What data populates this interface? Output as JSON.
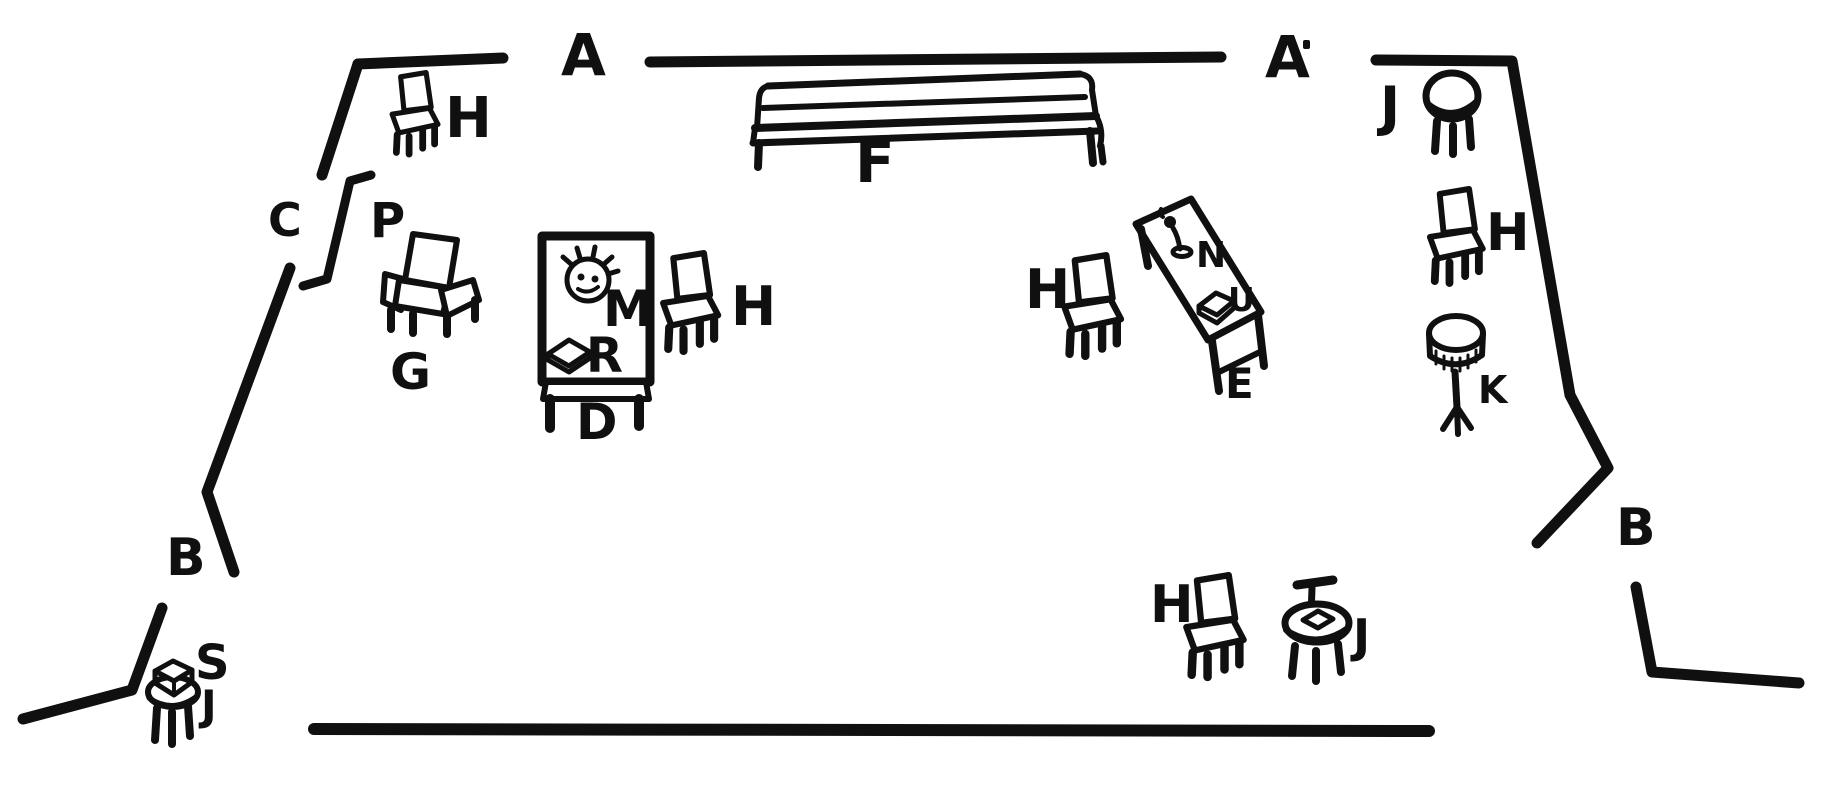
{
  "diagram": {
    "kind": "stage floor plan sketch",
    "ink_color": "#101010",
    "background_color": "#ffffff"
  },
  "labels": {
    "a_left": "A",
    "a_right": "A",
    "b_left": "B",
    "b_right": "B",
    "c_doorway": "C",
    "p_door": "P",
    "d_table": "D",
    "e_desk": "E",
    "f_settee": "F",
    "g_armchair": "G",
    "h_top_left": "H",
    "h_by_table_d": "H",
    "h_by_desk_e": "H",
    "h_right": "H",
    "h_down_right": "H",
    "j_up_right": "J",
    "j_down_right": "J",
    "j_down_left": "J",
    "k_stand": "K",
    "m_plant_bowl": "M",
    "n_telephone": "N",
    "r_book": "R",
    "s_box": "S",
    "u_box_on_desk": "U"
  },
  "furniture": [
    {
      "name": "chair-h-top-left",
      "label": "H",
      "kind": "side-chair"
    },
    {
      "name": "armchair-g",
      "label": "G",
      "kind": "armchair"
    },
    {
      "name": "table-d",
      "label": "D",
      "kind": "rectangular-table"
    },
    {
      "name": "plant-bowl-m",
      "label": "M",
      "kind": "flower-bowl"
    },
    {
      "name": "book-r",
      "label": "R",
      "kind": "book"
    },
    {
      "name": "chair-h-by-table-d",
      "label": "H",
      "kind": "side-chair"
    },
    {
      "name": "settee-f",
      "label": "F",
      "kind": "long-settee"
    },
    {
      "name": "chair-h-by-desk-e",
      "label": "H",
      "kind": "side-chair"
    },
    {
      "name": "desk-e",
      "label": "E",
      "kind": "angled-desk"
    },
    {
      "name": "telephone-n",
      "label": "N",
      "kind": "candlestick-telephone"
    },
    {
      "name": "box-u",
      "label": "U",
      "kind": "box"
    },
    {
      "name": "stool-j-up-right",
      "label": "J",
      "kind": "round-stool"
    },
    {
      "name": "chair-h-right",
      "label": "H",
      "kind": "side-chair"
    },
    {
      "name": "pedestal-k",
      "label": "K",
      "kind": "pedestal-stand"
    },
    {
      "name": "chair-h-down-right",
      "label": "H",
      "kind": "side-chair"
    },
    {
      "name": "table-j-down-right",
      "label": "J",
      "kind": "round-table"
    },
    {
      "name": "stool-j-down-left",
      "label": "J",
      "kind": "round-stool"
    },
    {
      "name": "box-s",
      "label": "S",
      "kind": "box"
    }
  ]
}
